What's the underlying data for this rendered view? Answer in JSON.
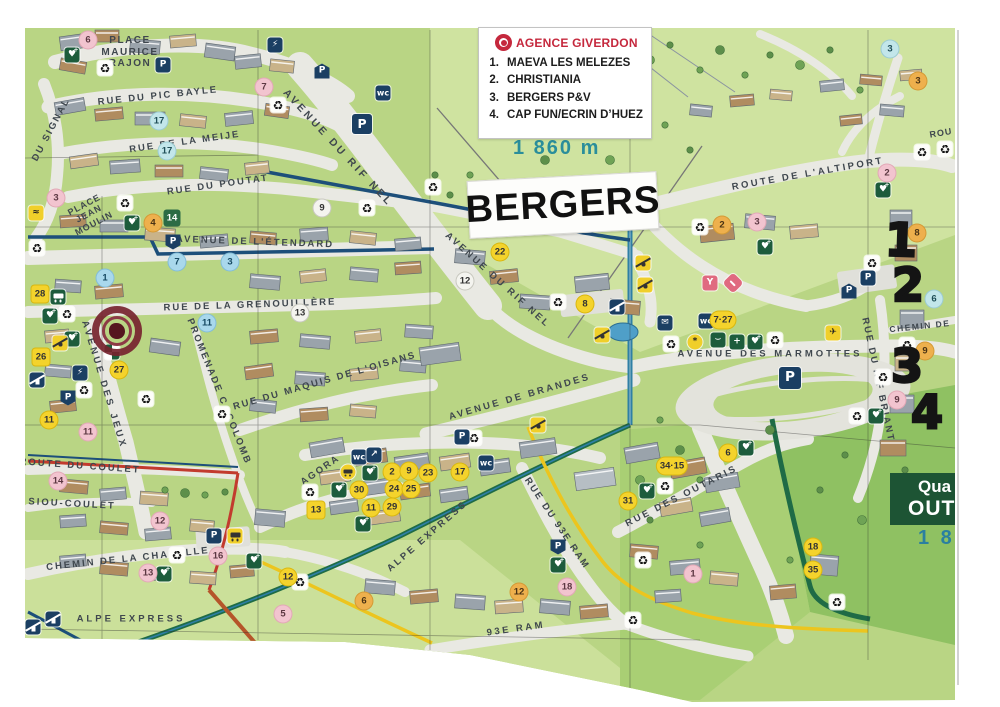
{
  "legend": {
    "title": "AGENCE GIVERDON",
    "items": [
      {
        "num": "1.",
        "label": "MAEVA LES MELEZES"
      },
      {
        "num": "2.",
        "label": "CHRISTIANIA"
      },
      {
        "num": "3.",
        "label": "BERGERS P&V"
      },
      {
        "num": "4.",
        "label": "CAP FUN/ECRIN D’HUEZ"
      }
    ]
  },
  "labels": {
    "bergers": "BERGERS",
    "altitude": "1 860 m",
    "quartier_line1": "Qua",
    "quartier_line2": "OUT",
    "quartier_alt": "1 8"
  },
  "colors": {
    "agency_red": "#c5283d",
    "map_green": "#b9d584",
    "road": "#e9e9e3",
    "marker_yellow": "#f4d32c",
    "marker_pink": "#f2c4cf",
    "boundary_blue": "#1d4f7a",
    "boundary_green": "#1f6b46",
    "boundary_yellow": "#ecc51e"
  },
  "handwritten": [
    {
      "value": "1",
      "x": 901,
      "y": 240,
      "rot": 2
    },
    {
      "value": "2",
      "x": 908,
      "y": 285,
      "rot": 0
    },
    {
      "value": "3",
      "x": 907,
      "y": 366,
      "rot": 0
    },
    {
      "value": "4",
      "x": 927,
      "y": 412,
      "rot": 0
    }
  ],
  "streets": [
    {
      "name": "PLACE MAURICE RAJON",
      "x": 130,
      "y": 52,
      "rot": 0,
      "ls": 1.5,
      "size": 10,
      "w": 62
    },
    {
      "name": "RUE DU PIC BAYLE",
      "x": 158,
      "y": 97,
      "rot": -6,
      "ls": 2
    },
    {
      "name": "RUE DE LA MEIJE",
      "x": 185,
      "y": 143,
      "rot": -8,
      "ls": 2
    },
    {
      "name": "RUE DU POUTAT",
      "x": 218,
      "y": 186,
      "rot": -8,
      "ls": 2
    },
    {
      "name": "DU SIGNAL",
      "x": 52,
      "y": 130,
      "rot": -62,
      "ls": 2
    },
    {
      "name": "AVENUE DU RIF NEL",
      "x": 338,
      "y": 148,
      "rot": 47,
      "ls": 3,
      "size": 10.5
    },
    {
      "name": "AVENUE DE L'ÉTENDARD",
      "x": 255,
      "y": 243,
      "rot": 2,
      "ls": 2
    },
    {
      "name": "RUE DE LA GRENOUILLÈRE",
      "x": 250,
      "y": 306,
      "rot": -2,
      "ls": 2
    },
    {
      "name": "PLACE JEAN MOULIN",
      "x": 89,
      "y": 214,
      "rot": -28,
      "ls": 1,
      "size": 9,
      "w": 66
    },
    {
      "name": "PROMENADE C. COLOMB",
      "x": 218,
      "y": 392,
      "rot": 68,
      "ls": 2
    },
    {
      "name": "AVENUE DES JEUX",
      "x": 103,
      "y": 385,
      "rot": 73,
      "ls": 3
    },
    {
      "name": "RUE DU MAQUIS DE L'OISANS",
      "x": 325,
      "y": 382,
      "rot": -16,
      "ls": 2
    },
    {
      "name": "AVENUE DE BRANDES",
      "x": 520,
      "y": 398,
      "rot": -16,
      "ls": 2.5
    },
    {
      "name": "AVENUE DU RIF NEL",
      "x": 497,
      "y": 281,
      "rot": 42,
      "ls": 2.5
    },
    {
      "name": "AVENUE DES MARMOTTES",
      "x": 770,
      "y": 355,
      "rot": 0,
      "ls": 3
    },
    {
      "name": "RUE DU RIF BRIANT",
      "x": 877,
      "y": 380,
      "rot": 78,
      "ls": 2
    },
    {
      "name": "ROUTE DE L'ALTIPORT",
      "x": 808,
      "y": 175,
      "rot": -10,
      "ls": 2.5
    },
    {
      "name": "ROUTE DU COULET",
      "x": 80,
      "y": 467,
      "rot": 4,
      "ls": 2
    },
    {
      "name": "SIOU-COULET",
      "x": 72,
      "y": 505,
      "rot": 3,
      "ls": 2
    },
    {
      "name": "CHEMIN DE LA CHAPELLE",
      "x": 128,
      "y": 560,
      "rot": -6,
      "ls": 2
    },
    {
      "name": "ALPE EXPRESS",
      "x": 131,
      "y": 620,
      "rot": 0,
      "ls": 3
    },
    {
      "name": "ALPE EXPRESS",
      "x": 428,
      "y": 537,
      "rot": -41,
      "ls": 2.5
    },
    {
      "name": "AGORA",
      "x": 321,
      "y": 471,
      "rot": -35,
      "ls": 2
    },
    {
      "name": "RUE DU 93E RAM",
      "x": 556,
      "y": 524,
      "rot": 56,
      "ls": 2
    },
    {
      "name": "93E RAM",
      "x": 516,
      "y": 630,
      "rot": -8,
      "ls": 2.5
    },
    {
      "name": "RUE DES OUTARIS",
      "x": 682,
      "y": 497,
      "rot": -27,
      "ls": 2.5
    },
    {
      "name": "CHEMIN DE",
      "x": 920,
      "y": 327,
      "rot": -6,
      "ls": 1.5,
      "size": 8.5
    },
    {
      "name": "ROU",
      "x": 941,
      "y": 133,
      "rot": -10,
      "ls": 1,
      "size": 9
    }
  ],
  "markers": [
    {
      "label": "6",
      "type": "pink",
      "x": 88,
      "y": 40
    },
    {
      "label": "7",
      "type": "pink",
      "x": 264,
      "y": 87
    },
    {
      "label": "3",
      "type": "pink",
      "x": 56,
      "y": 198
    },
    {
      "label": "11",
      "type": "pink",
      "x": 88,
      "y": 432
    },
    {
      "label": "14",
      "type": "pink",
      "x": 58,
      "y": 481
    },
    {
      "label": "12",
      "type": "pink",
      "x": 160,
      "y": 521
    },
    {
      "label": "13",
      "type": "pink",
      "x": 148,
      "y": 573
    },
    {
      "label": "16",
      "type": "pink",
      "x": 218,
      "y": 556
    },
    {
      "label": "5",
      "type": "pink",
      "x": 283,
      "y": 614
    },
    {
      "label": "18",
      "type": "pink",
      "x": 567,
      "y": 587
    },
    {
      "label": "1",
      "type": "pink",
      "x": 693,
      "y": 574
    },
    {
      "label": "2",
      "type": "pink",
      "x": 887,
      "y": 173
    },
    {
      "label": "3",
      "type": "pink",
      "x": 757,
      "y": 222
    },
    {
      "label": "9",
      "type": "pink",
      "x": 897,
      "y": 400
    },
    {
      "label": "4",
      "type": "tan",
      "x": 153,
      "y": 223
    },
    {
      "label": "2",
      "type": "tan",
      "x": 722,
      "y": 225
    },
    {
      "label": "3",
      "type": "tan",
      "x": 918,
      "y": 81
    },
    {
      "label": "6",
      "type": "tan",
      "x": 364,
      "y": 601
    },
    {
      "label": "12",
      "type": "tan",
      "x": 519,
      "y": 592
    },
    {
      "label": "9",
      "type": "tan",
      "x": 925,
      "y": 351
    },
    {
      "label": "8",
      "type": "tan",
      "x": 917,
      "y": 233
    },
    {
      "label": "17",
      "type": "teal",
      "x": 159,
      "y": 121
    },
    {
      "label": "17",
      "type": "teal",
      "x": 167,
      "y": 151
    },
    {
      "label": "3",
      "type": "teal",
      "x": 890,
      "y": 49
    },
    {
      "label": "6",
      "type": "teal",
      "x": 934,
      "y": 299
    },
    {
      "label": "1",
      "type": "blue",
      "x": 105,
      "y": 278
    },
    {
      "label": "7",
      "type": "blue",
      "x": 177,
      "y": 262
    },
    {
      "label": "3",
      "type": "blue",
      "x": 230,
      "y": 262
    },
    {
      "label": "11",
      "type": "blue",
      "x": 207,
      "y": 323
    },
    {
      "label": "12",
      "type": "white",
      "x": 465,
      "y": 281
    },
    {
      "label": "9",
      "type": "white",
      "x": 322,
      "y": 208
    },
    {
      "label": "13",
      "type": "white",
      "x": 300,
      "y": 313
    },
    {
      "label": "22",
      "type": "yellow",
      "x": 500,
      "y": 252
    },
    {
      "label": "8",
      "type": "yellow",
      "x": 585,
      "y": 304
    },
    {
      "label": "27",
      "type": "yellow",
      "x": 119,
      "y": 370
    },
    {
      "label": "11",
      "type": "yellow",
      "x": 49,
      "y": 420
    },
    {
      "label": "2",
      "type": "yellow",
      "x": 392,
      "y": 472
    },
    {
      "label": "9",
      "type": "yellow",
      "x": 409,
      "y": 471
    },
    {
      "label": "23",
      "type": "yellow",
      "x": 428,
      "y": 473
    },
    {
      "label": "24",
      "type": "yellow",
      "x": 394,
      "y": 489
    },
    {
      "label": "25",
      "type": "yellow",
      "x": 411,
      "y": 489
    },
    {
      "label": "30",
      "type": "yellow",
      "x": 359,
      "y": 490
    },
    {
      "label": "11",
      "type": "yellow",
      "x": 371,
      "y": 508
    },
    {
      "label": "29",
      "type": "yellow",
      "x": 392,
      "y": 507
    },
    {
      "label": "17",
      "type": "yellow",
      "x": 460,
      "y": 472
    },
    {
      "label": "31",
      "type": "yellow",
      "x": 628,
      "y": 501
    },
    {
      "label": "6",
      "type": "yellow",
      "x": 728,
      "y": 453
    },
    {
      "label": "18",
      "type": "yellow",
      "x": 813,
      "y": 547
    },
    {
      "label": "35",
      "type": "yellow",
      "x": 813,
      "y": 570
    },
    {
      "label": "12",
      "type": "yellow",
      "x": 288,
      "y": 577
    },
    {
      "label": "7·27",
      "type": "yellow",
      "x": 723,
      "y": 320
    },
    {
      "label": "34·15",
      "type": "yellow",
      "x": 672,
      "y": 466
    },
    {
      "label": "28",
      "type": "yellowsq",
      "x": 40,
      "y": 294
    },
    {
      "label": "26",
      "type": "yellowsq",
      "x": 41,
      "y": 357
    },
    {
      "label": "13",
      "type": "yellowsq",
      "x": 316,
      "y": 510
    },
    {
      "label": "14",
      "type": "greensq",
      "x": 172,
      "y": 218
    }
  ],
  "icons": [
    {
      "type": "recycle",
      "x": 105,
      "y": 68
    },
    {
      "type": "recycle",
      "x": 278,
      "y": 105
    },
    {
      "type": "recycle",
      "x": 433,
      "y": 187
    },
    {
      "type": "recycle",
      "x": 367,
      "y": 208
    },
    {
      "type": "recycle",
      "x": 125,
      "y": 203
    },
    {
      "type": "recycle",
      "x": 37,
      "y": 248
    },
    {
      "type": "recycle",
      "x": 67,
      "y": 314
    },
    {
      "type": "recycle",
      "x": 84,
      "y": 390
    },
    {
      "type": "recycle",
      "x": 146,
      "y": 399
    },
    {
      "type": "recycle",
      "x": 222,
      "y": 414
    },
    {
      "type": "recycle",
      "x": 558,
      "y": 302
    },
    {
      "type": "recycle",
      "x": 700,
      "y": 227
    },
    {
      "type": "recycle",
      "x": 922,
      "y": 152
    },
    {
      "type": "recycle",
      "x": 945,
      "y": 149
    },
    {
      "type": "recycle",
      "x": 872,
      "y": 263
    },
    {
      "type": "recycle",
      "x": 883,
      "y": 377
    },
    {
      "type": "recycle",
      "x": 671,
      "y": 344
    },
    {
      "type": "recycle",
      "x": 775,
      "y": 340
    },
    {
      "type": "recycle",
      "x": 857,
      "y": 416
    },
    {
      "type": "recycle",
      "x": 474,
      "y": 438
    },
    {
      "type": "recycle",
      "x": 310,
      "y": 492
    },
    {
      "type": "recycle",
      "x": 177,
      "y": 555
    },
    {
      "type": "recycle",
      "x": 643,
      "y": 560
    },
    {
      "type": "recycle",
      "x": 633,
      "y": 620
    },
    {
      "type": "recycle",
      "x": 837,
      "y": 602
    },
    {
      "type": "recycle",
      "x": 665,
      "y": 486
    },
    {
      "type": "recycle",
      "x": 300,
      "y": 582
    },
    {
      "type": "recycle",
      "x": 907,
      "y": 345
    },
    {
      "type": "park",
      "x": 163,
      "y": 65
    },
    {
      "type": "park",
      "x": 362,
      "y": 124,
      "s": 20
    },
    {
      "type": "park",
      "x": 868,
      "y": 278
    },
    {
      "type": "park",
      "x": 214,
      "y": 536
    },
    {
      "type": "park",
      "x": 462,
      "y": 437
    },
    {
      "type": "park",
      "x": 790,
      "y": 378,
      "s": 22
    },
    {
      "type": "parkhouse",
      "x": 322,
      "y": 71
    },
    {
      "type": "parkhouse",
      "x": 849,
      "y": 291
    },
    {
      "type": "parkflag",
      "x": 173,
      "y": 242
    },
    {
      "type": "parkflag",
      "x": 68,
      "y": 398
    },
    {
      "type": "parkflag",
      "x": 558,
      "y": 547
    },
    {
      "type": "wc",
      "x": 383,
      "y": 93
    },
    {
      "type": "wc",
      "x": 706,
      "y": 321
    },
    {
      "type": "wc",
      "x": 359,
      "y": 457
    },
    {
      "type": "wc",
      "x": 486,
      "y": 463
    },
    {
      "type": "defib",
      "x": 72,
      "y": 55
    },
    {
      "type": "defib",
      "x": 132,
      "y": 223
    },
    {
      "type": "defib",
      "x": 50,
      "y": 316
    },
    {
      "type": "defib",
      "x": 72,
      "y": 339
    },
    {
      "type": "defib",
      "x": 370,
      "y": 473
    },
    {
      "type": "defib",
      "x": 339,
      "y": 490
    },
    {
      "type": "defib",
      "x": 363,
      "y": 524
    },
    {
      "type": "defib",
      "x": 755,
      "y": 342
    },
    {
      "type": "defib",
      "x": 883,
      "y": 190
    },
    {
      "type": "defib",
      "x": 765,
      "y": 247
    },
    {
      "type": "defib",
      "x": 746,
      "y": 448
    },
    {
      "type": "defib",
      "x": 647,
      "y": 491
    },
    {
      "type": "defib",
      "x": 558,
      "y": 565
    },
    {
      "type": "defib",
      "x": 164,
      "y": 574
    },
    {
      "type": "defib",
      "x": 254,
      "y": 561
    },
    {
      "type": "defib",
      "x": 876,
      "y": 416
    },
    {
      "type": "cross",
      "x": 737,
      "y": 342
    },
    {
      "type": "steth",
      "x": 718,
      "y": 340
    },
    {
      "type": "bus",
      "x": 58,
      "y": 297
    },
    {
      "type": "busy",
      "x": 235,
      "y": 536
    },
    {
      "type": "plug",
      "x": 275,
      "y": 45
    },
    {
      "type": "plug",
      "x": 80,
      "y": 373
    },
    {
      "type": "lift",
      "x": 617,
      "y": 307
    },
    {
      "type": "lift",
      "x": 53,
      "y": 619
    },
    {
      "type": "lift",
      "x": 33,
      "y": 627
    },
    {
      "type": "lift",
      "x": 37,
      "y": 380
    },
    {
      "type": "skiy",
      "x": 643,
      "y": 263
    },
    {
      "type": "skiy",
      "x": 645,
      "y": 285
    },
    {
      "type": "skiy",
      "x": 602,
      "y": 335
    },
    {
      "type": "skiy",
      "x": 538,
      "y": 425
    },
    {
      "type": "skiy",
      "x": 60,
      "y": 343
    },
    {
      "type": "plane",
      "x": 833,
      "y": 333
    },
    {
      "type": "bar",
      "x": 710,
      "y": 283
    },
    {
      "type": "drink",
      "x": 733,
      "y": 283
    },
    {
      "type": "post",
      "x": 665,
      "y": 323
    },
    {
      "type": "pool",
      "x": 36,
      "y": 213
    },
    {
      "type": "flagcheck",
      "x": 112,
      "y": 352
    },
    {
      "type": "climb",
      "x": 374,
      "y": 455
    },
    {
      "type": "car",
      "x": 348,
      "y": 472
    },
    {
      "type": "ycircle",
      "x": 695,
      "y": 342
    }
  ]
}
